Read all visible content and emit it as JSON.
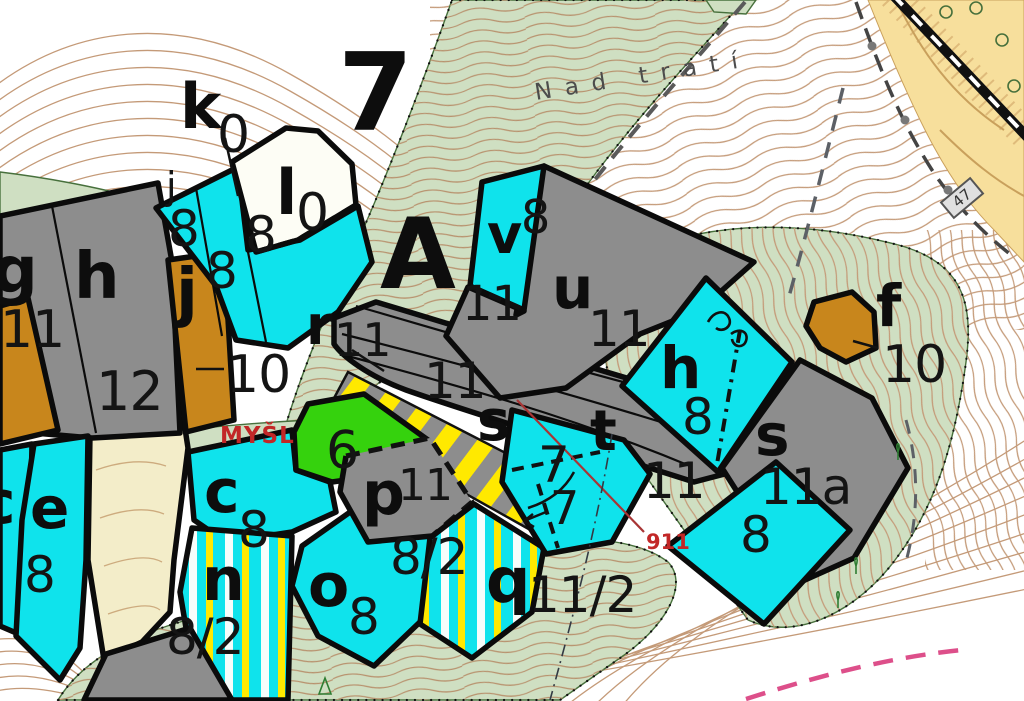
{
  "labels": {
    "region_number": "7",
    "section_letter": "A",
    "place_name": "Nad tratí",
    "place_name_partial": "MYŠL",
    "ref_line_number": "911",
    "building_number": "47",
    "parcels": {
      "k": {
        "letter": "k",
        "value": "0"
      },
      "l": {
        "letter": "l",
        "value": "0"
      },
      "j_top": {
        "letter": "j",
        "value": "8"
      },
      "top8_mid": {
        "value": "8"
      },
      "top8_right": {
        "value": "8"
      },
      "g": {
        "letter": "g",
        "value": "11"
      },
      "h": {
        "letter": "h",
        "value": "12"
      },
      "j": {
        "letter": "j",
        "value": "10"
      },
      "r": {
        "letter": "r",
        "value": "11"
      },
      "road_upper": {
        "value": "11"
      },
      "v": {
        "letter": "v",
        "value": "8"
      },
      "v_sub": {
        "value": "11"
      },
      "u": {
        "letter": "u",
        "value": "11"
      },
      "h_east": {
        "letter": "h",
        "value": "8"
      },
      "f": {
        "letter": "f",
        "value": "10"
      },
      "s_road": {
        "letter": "s"
      },
      "t": {
        "letter": "t"
      },
      "seven_upper": {
        "value": "7"
      },
      "seven_lower": {
        "value": "7"
      },
      "road_lower": {
        "value": "11"
      },
      "s_east": {
        "letter": "s",
        "value": "11a"
      },
      "eight_southeast": {
        "value": "8"
      },
      "six": {
        "value": "6"
      },
      "c": {
        "letter": "c",
        "value": "8"
      },
      "c_partial": {
        "letter": "c"
      },
      "e": {
        "letter": "e",
        "value": "8"
      },
      "n": {
        "letter": "n",
        "value": "8/2"
      },
      "o": {
        "letter": "o",
        "value": "8"
      },
      "p": {
        "letter": "p",
        "value": "11"
      },
      "stripe_parcel": {
        "value": "8/2"
      },
      "q": {
        "letter": "q",
        "value": "11/2"
      }
    }
  },
  "colors": {
    "parcel_cyan": "#0fe3ec",
    "parcel_gray": "#8d8d8d",
    "parcel_ochre": "#c8861c",
    "parcel_green": "#35d20d",
    "meadow_sage": "#cfdfc2",
    "stripe_yellow": "#ffe900",
    "railway_area_tan": "#f7df9c",
    "contour_brown": "#c49a78",
    "red_label": "#c22727",
    "pink_line": "#dd4f8a"
  }
}
